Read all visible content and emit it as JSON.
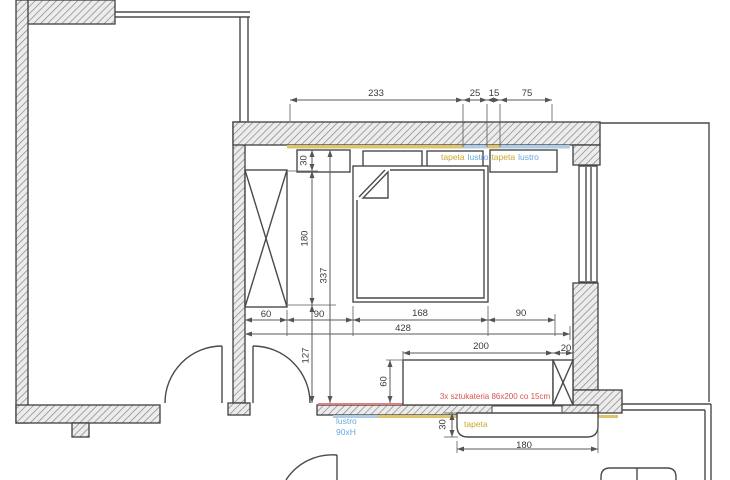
{
  "drawing": {
    "type": "floor-plan",
    "room": "bedroom",
    "units": "cm",
    "dims": {
      "top_233": "233",
      "top_25": "25",
      "top_15": "15",
      "top_75": "75",
      "left_30": "30",
      "left_180": "180",
      "left_127": "127",
      "left_337": "337",
      "bottom_60": "60",
      "bottom_90_left": "90",
      "bed_168": "168",
      "bed_90_right": "90",
      "total_428": "428",
      "bench_200": "200",
      "bench_20": "20",
      "bench_60": "60",
      "sofa_30": "30",
      "sofa_180": "180"
    },
    "labels": {
      "tapeta_1": "tapeta",
      "lustro_1": "lustro",
      "tapeta_2": "tapeta",
      "lustro_2": "lustro",
      "stucco_note": "3x sztukateria 86x200 co 15cm",
      "mirror_note_line1": "lustro",
      "mirror_note_line2": "90xH",
      "wallpaper_note": "tapeta"
    },
    "colors": {
      "wallpaper_accent": "#c9a52f",
      "mirror_accent": "#68a9e0",
      "stucco_accent": "#d9534f",
      "wallpaper_strip": "#dcc56d",
      "mirror_strip": "#aecbe8",
      "stucco_line": "#e07f7f",
      "wall_line": "#3f3f3f",
      "dim_line": "#5a5a5a"
    }
  }
}
